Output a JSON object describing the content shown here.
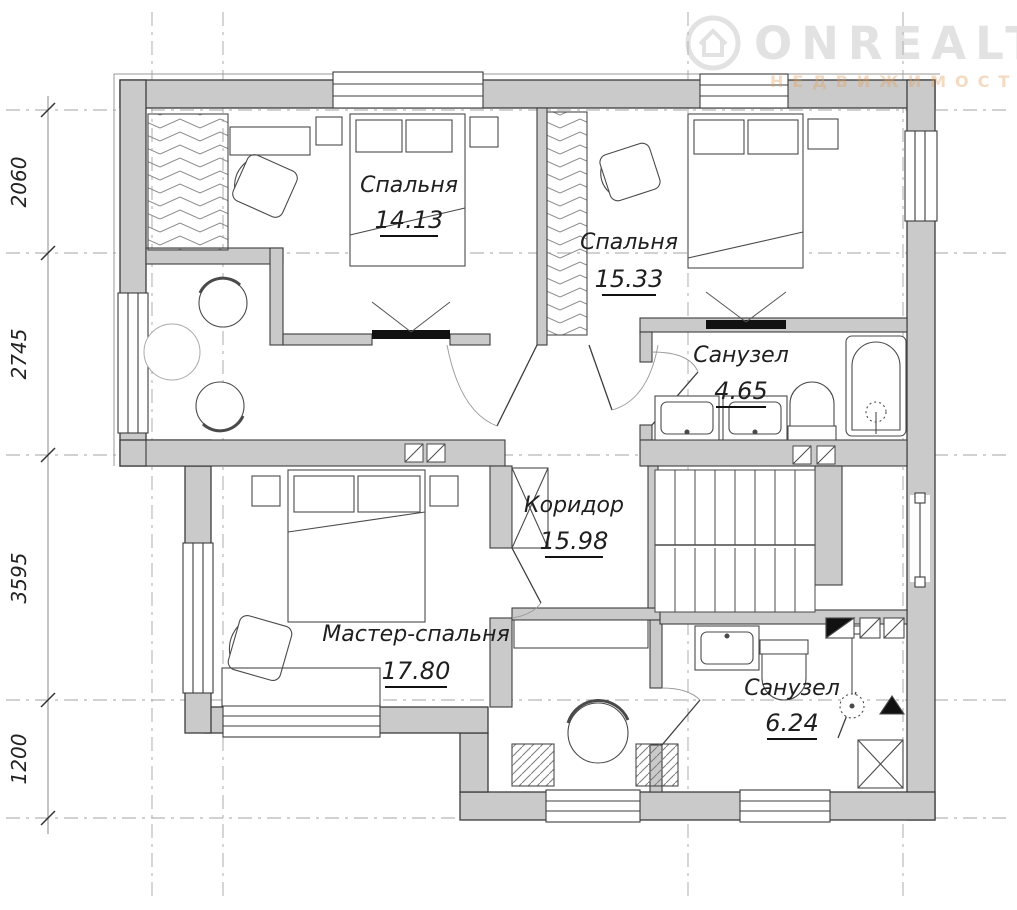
{
  "watermark": {
    "brand": "ONREALT",
    "subtitle": "НЕДВИЖИМОСТЬ"
  },
  "rooms": [
    {
      "name": "Спальня",
      "area": "14.13"
    },
    {
      "name": "Спальня",
      "area": "15.33"
    },
    {
      "name": "Санузел",
      "area": "4.65"
    },
    {
      "name": "Коридор",
      "area": "15.98"
    },
    {
      "name": "Мастер-спальня",
      "area": "17.80"
    },
    {
      "name": "Санузел",
      "area": "6.24"
    }
  ],
  "dimensions": [
    "2060",
    "2745",
    "3595",
    "1200"
  ],
  "colors": {
    "wall_fill": "#cacaca",
    "outline": "#3c3c3c",
    "grid": "#a3a3a3",
    "label": "#1f1f1f",
    "watermark_gray": "#dcdcdc",
    "watermark_tan": "#f0d6ba",
    "threshold_black": "#111111"
  }
}
